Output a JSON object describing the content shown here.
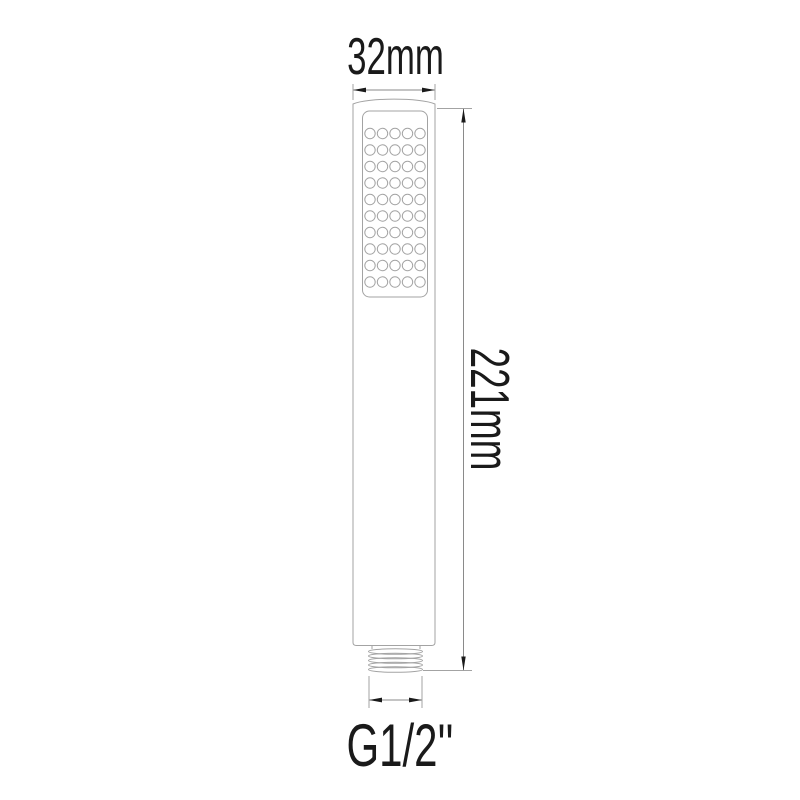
{
  "diagram": {
    "description": "technical dimension drawing of a handheld shower wand",
    "labels": {
      "width": "32mm",
      "height": "221mm",
      "thread": "G1/2''"
    },
    "spray_face": {
      "hole_columns": 5,
      "hole_rows": 10
    },
    "colors": {
      "background": "#ffffff",
      "outline": "#a3a3a3",
      "dimension_line": "#8a8a8a",
      "arrow": "#1a1a1a",
      "text": "#1a1a1a"
    }
  }
}
